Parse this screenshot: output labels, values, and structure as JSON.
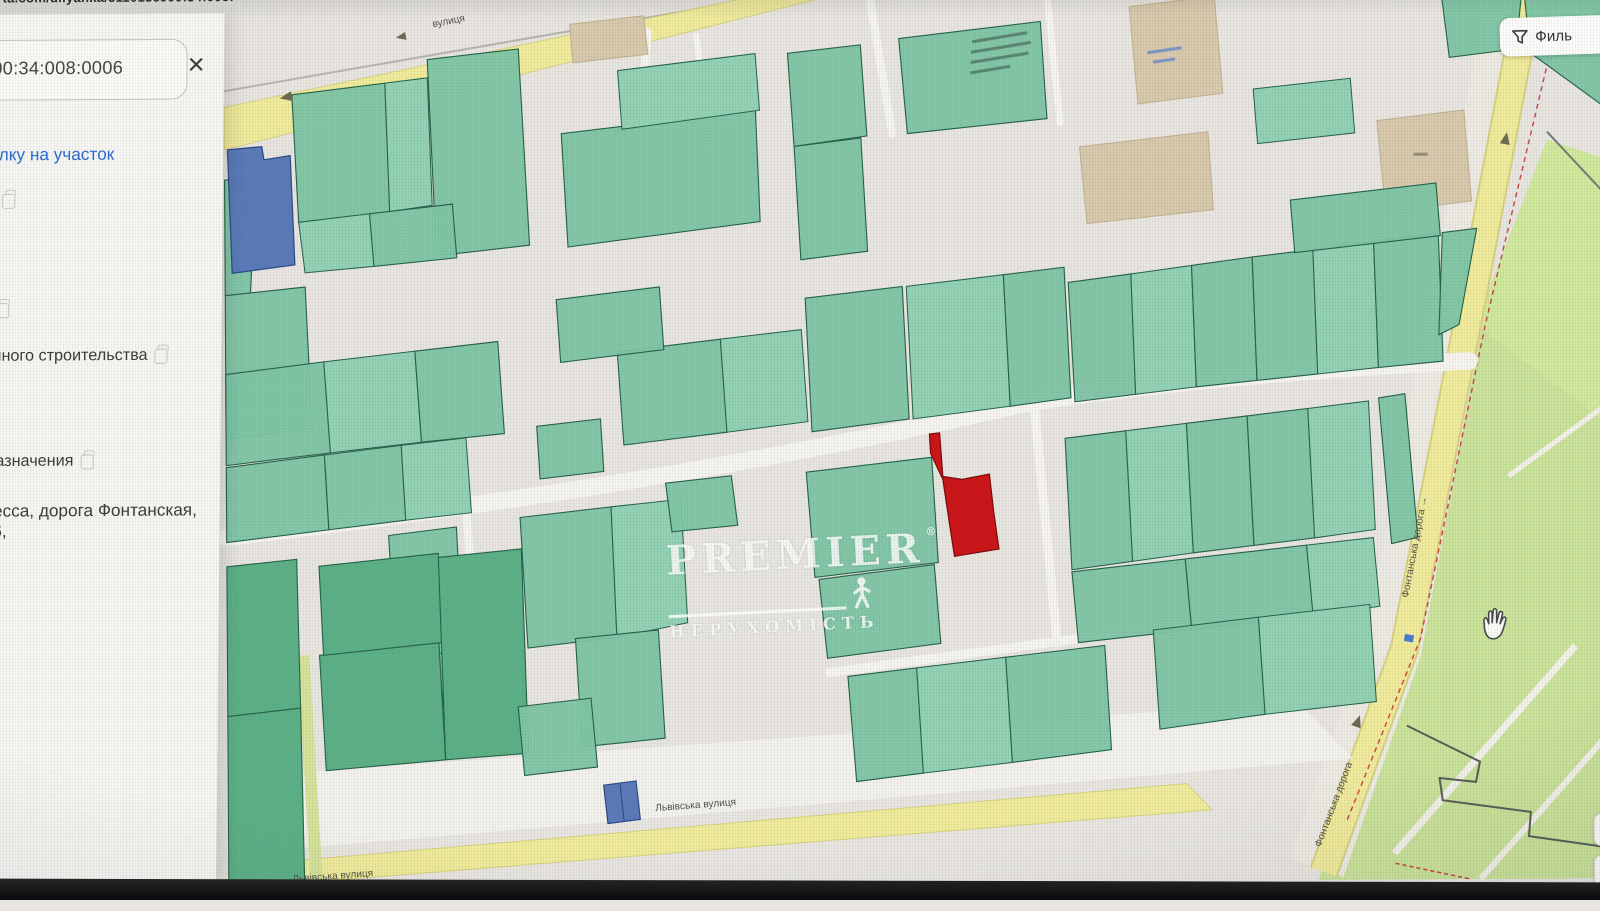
{
  "theme": {
    "bg": "#e9e6e1",
    "parcel": "#7fc6a6",
    "parcelBorder": "#26624a",
    "parcelDark": "#5db187",
    "parcelLight": "#93d2b5",
    "street": "#f7f5f0",
    "road": "#f1eb9c",
    "park": "#cbe39b",
    "red": "#cc1518",
    "redBorder": "#7e0a0c",
    "blue": "#5b7ab9",
    "blueBorder": "#2c4a8a",
    "link": "#2b6cd4"
  },
  "browser": {
    "url_fragment": "arta.com/dilyanka/5110136900:34:008:0006"
  },
  "sidebar": {
    "search": {
      "value": "00:34:008:0006"
    },
    "close_label": "×",
    "copy_link_label": "ылку на участок",
    "rows": [
      {
        "value": "1"
      },
      {
        "value": "ь"
      },
      {
        "value": "ачного строительства"
      },
      {
        "value": "назначения"
      },
      {
        "value": "десса, дорога Фонтанская, 86,"
      }
    ]
  },
  "map": {
    "filter_label": "Филь",
    "labels": {
      "street_top": "вулиця",
      "lvivska_1": "Львівська вулиця",
      "lvivska_2": "Львівська вулиця",
      "fontanska_1": "Фонтанська дорога →",
      "fontanska_2": "Фонтанська дорога"
    },
    "watermark": {
      "brand": "PREMIER",
      "reg": "®",
      "sub": "НЕРУХОМІСТЬ"
    },
    "controls": {
      "zoom_in": "+",
      "zoom_out": "−"
    }
  }
}
